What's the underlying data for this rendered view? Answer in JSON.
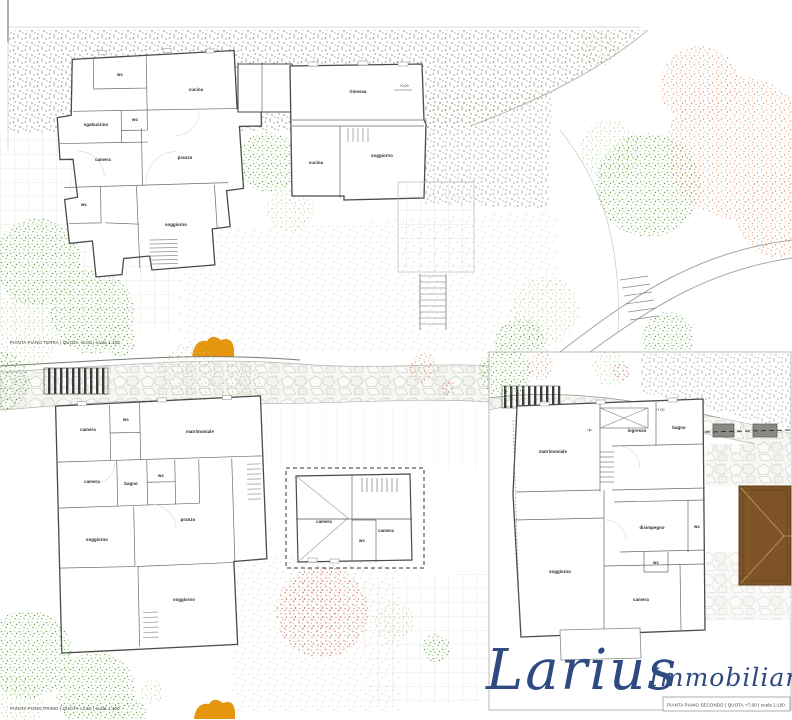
{
  "logo": {
    "name": "Larius",
    "suffix": "Immobiliare",
    "color": "#2f4a80"
  },
  "colors": {
    "terrain_dots": "#8a7355",
    "garden_dots": "#b8ab92",
    "tree_green": "#7ab357",
    "tree_salmon": "#e09a72",
    "tree_red": "#d4887b",
    "orange_tree": "#e6950e",
    "roof_brown": "#7d5327",
    "wall": "#4a4a4a"
  },
  "plans": {
    "terra": {
      "caption": "PIANTA PIANO TERRA | QUOTA +0,00 | scala 1:100",
      "rooms": {
        "wc_a": "wc",
        "cucina_l": "cucina",
        "sgabuzzino": "sgabuzzino",
        "wc_b": "wc",
        "camera": "camera",
        "pranzo": "pranzo",
        "wc_c": "wc",
        "soggiorno": "soggiorno",
        "rimessa": "rimessa",
        "cucina_r": "cucina",
        "soggiorno2": "soggiorno",
        "quota": "+0,00"
      }
    },
    "primo": {
      "caption": "PIANTA PIANO PRIMO | QUOTA +3,50 | scala 1:100",
      "rooms": {
        "camera_a": "camera",
        "wc_a": "wc",
        "matrimoniale": "matrimoniale",
        "camera_b": "camera",
        "bagno": "bagno",
        "wc_b": "wc",
        "pranzo": "pranzo",
        "soggiorno_a": "soggiorno",
        "soggiorno_b": "soggiorno",
        "dep_camera_a": "camera",
        "dep_wc": "wc",
        "dep_camera_b": "camera"
      }
    },
    "secondo": {
      "caption": "PIANTA PIANO SECONDO | QUOTA +7,00 | scala 1:100",
      "rooms": {
        "matrimoniale": "matrimoniale",
        "rip": "rip.",
        "ingresso": "ingresso",
        "bagno": "bagno",
        "disimpegno": "disimpegno",
        "wc_a": "wc",
        "wc_b": "wc",
        "soggiorno": "soggiorno",
        "camera": "camera",
        "quota": "+7,00"
      }
    }
  }
}
